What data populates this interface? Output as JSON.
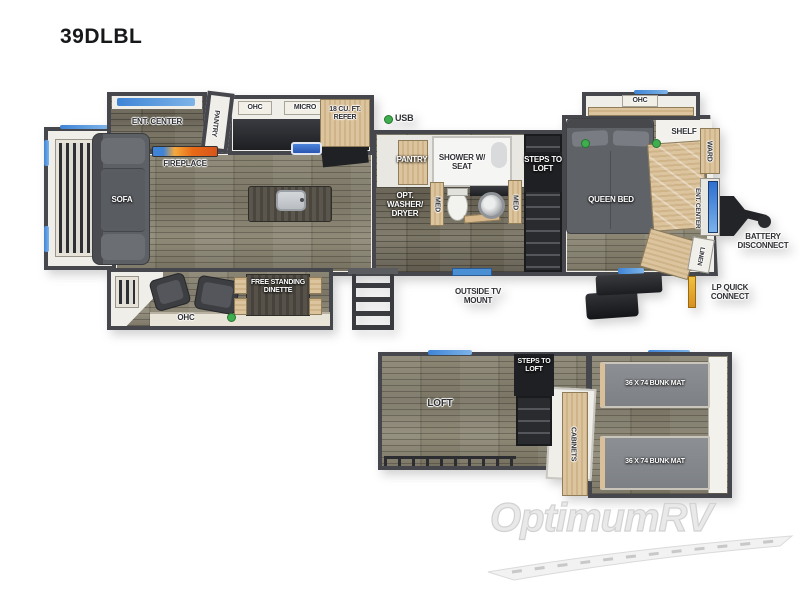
{
  "title": "39DLBL",
  "watermark": "OptimumRV",
  "colors": {
    "wall": "#45474d",
    "floor_wood": "#8a8574",
    "cabinet_tan": "#d9c09a",
    "accent_blue": "#4a8fd4",
    "fireplace_orange": "#e86a18",
    "indicator_green": "#3fae4e",
    "lp_yellow": "#e8b22a",
    "furniture_gray": "#5d6065",
    "steps_black": "#232427",
    "watermark_gray": "#e2e2e2"
  },
  "main_floor": {
    "rear": {
      "sofa": "SOFA"
    },
    "living": {
      "ent_center": "ENT. CENTER",
      "fireplace": "FIREPLACE",
      "pantry": "PANTRY"
    },
    "kitchen": {
      "ohc": "OHC",
      "micro": "MICRO",
      "refer": "18 CU. FT. REFER",
      "usb": "USB"
    },
    "bath": {
      "pantry": "PANTRY",
      "shower": "SHOWER W/ SEAT",
      "washer": "OPT. WASHER/ DRYER",
      "med_left": "MED",
      "med_right": "MED"
    },
    "steps": "STEPS TO LOFT",
    "bedroom": {
      "queen_bed": "QUEEN BED",
      "ohc": "OHC",
      "shelf": "SHELF",
      "ward": "WARD",
      "ent_center": "ENT. CENTER",
      "linen": "LINEN"
    },
    "dinette": {
      "free_standing": "FREE STANDING DINETTE",
      "ohc": "OHC"
    },
    "exterior": {
      "battery": "BATTERY DISCONNECT",
      "lp": "LP QUICK CONNECT",
      "tv_mount": "OUTSIDE TV MOUNT"
    }
  },
  "loft_floor": {
    "loft": "LOFT",
    "steps": "STEPS TO LOFT",
    "cabinets": "CABINETS",
    "bunk_top": "36 X 74 BUNK MAT",
    "bunk_bottom": "36 X 74 BUNK MAT"
  }
}
